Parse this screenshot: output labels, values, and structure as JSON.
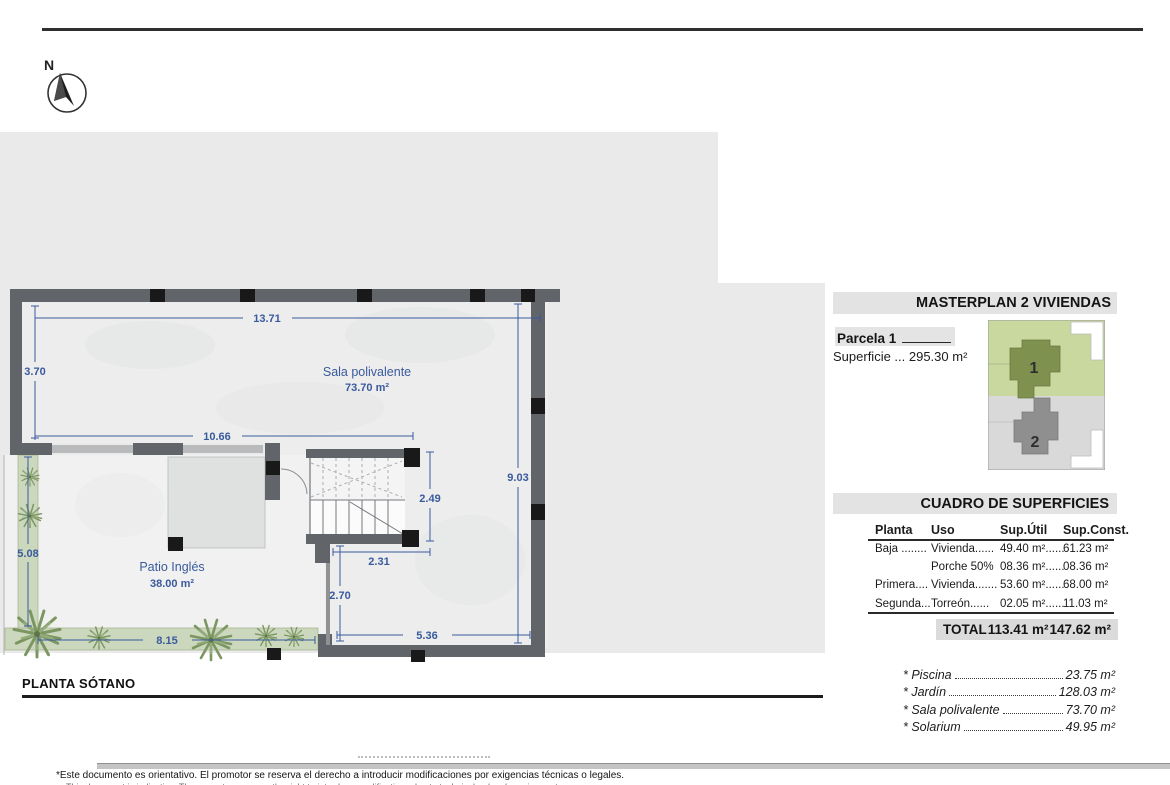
{
  "compass": {
    "north_label": "N"
  },
  "plan": {
    "title": "PLANTA SÓTANO",
    "rooms": {
      "sala": {
        "name": "Sala polivalente",
        "area": "73.70 m²"
      },
      "patio": {
        "name": "Patio Inglés",
        "area": "38.00 m²"
      }
    },
    "dims": {
      "top": "13.71",
      "left_upper": "3.70",
      "mid": "10.66",
      "right": "9.03",
      "stair": "2.49",
      "left_lower": "5.08",
      "below_stair": "2.31",
      "mid_lower": "2.70",
      "bottom_left": "8.15",
      "bottom_right": "5.36"
    }
  },
  "masterplan": {
    "title": "MASTERPLAN 2 VIVIENDAS",
    "parcel": "Parcela 1",
    "surface": "Superficie ... 295.30 m²",
    "plot1": "1",
    "plot2": "2"
  },
  "surfaces": {
    "title": "CUADRO DE SUPERFICIES",
    "col_planta": "Planta",
    "col_uso": "Uso",
    "col_util": "Sup.Útil",
    "col_const": "Sup.Const.",
    "rows": [
      {
        "planta": "Baja ........",
        "uso": "Vivienda......",
        "util": "49.40 m²......",
        "konst": "61.23 m²"
      },
      {
        "planta": "",
        "uso": "Porche 50%",
        "util": "08.36 m²......",
        "konst": "08.36 m²"
      },
      {
        "planta": "Primera....",
        "uso": "Vivienda.......",
        "util": "53.60 m²......",
        "konst": "68.00 m²"
      },
      {
        "planta": "Segunda...",
        "uso": "Torreón......",
        "util": "02.05 m²......",
        "konst": "11.03 m²"
      }
    ],
    "total_label": "TOTAL",
    "total_util": "113.41 m²",
    "total_const": "147.62 m²",
    "extras": [
      {
        "name": "* Piscina",
        "value": "23.75 m²"
      },
      {
        "name": "* Jardín",
        "value": "128.03 m²"
      },
      {
        "name": "* Sala polivalente",
        "value": "73.70 m²"
      },
      {
        "name": "* Solarium",
        "value": "49.95 m²"
      }
    ]
  },
  "footer": {
    "disclaimer_es": "*Este documento es orientativo. El promotor se reserva el derecho a introducir modificaciones por exigencias técnicas o legales.",
    "disclaimer_en": "This document is indicative. The promoter reserves the right to introduce modifications due to technical or legal requirements."
  },
  "colors": {
    "dim_blue": "#3a5a9e",
    "wall_gray": "#616468",
    "garden_green": "#cbd8bd",
    "plot_green": "#c9d89e",
    "plot_olive": "#7e914f",
    "plot_gray_light": "#d9d9d9",
    "plot_gray_dark": "#8f8f8f"
  }
}
